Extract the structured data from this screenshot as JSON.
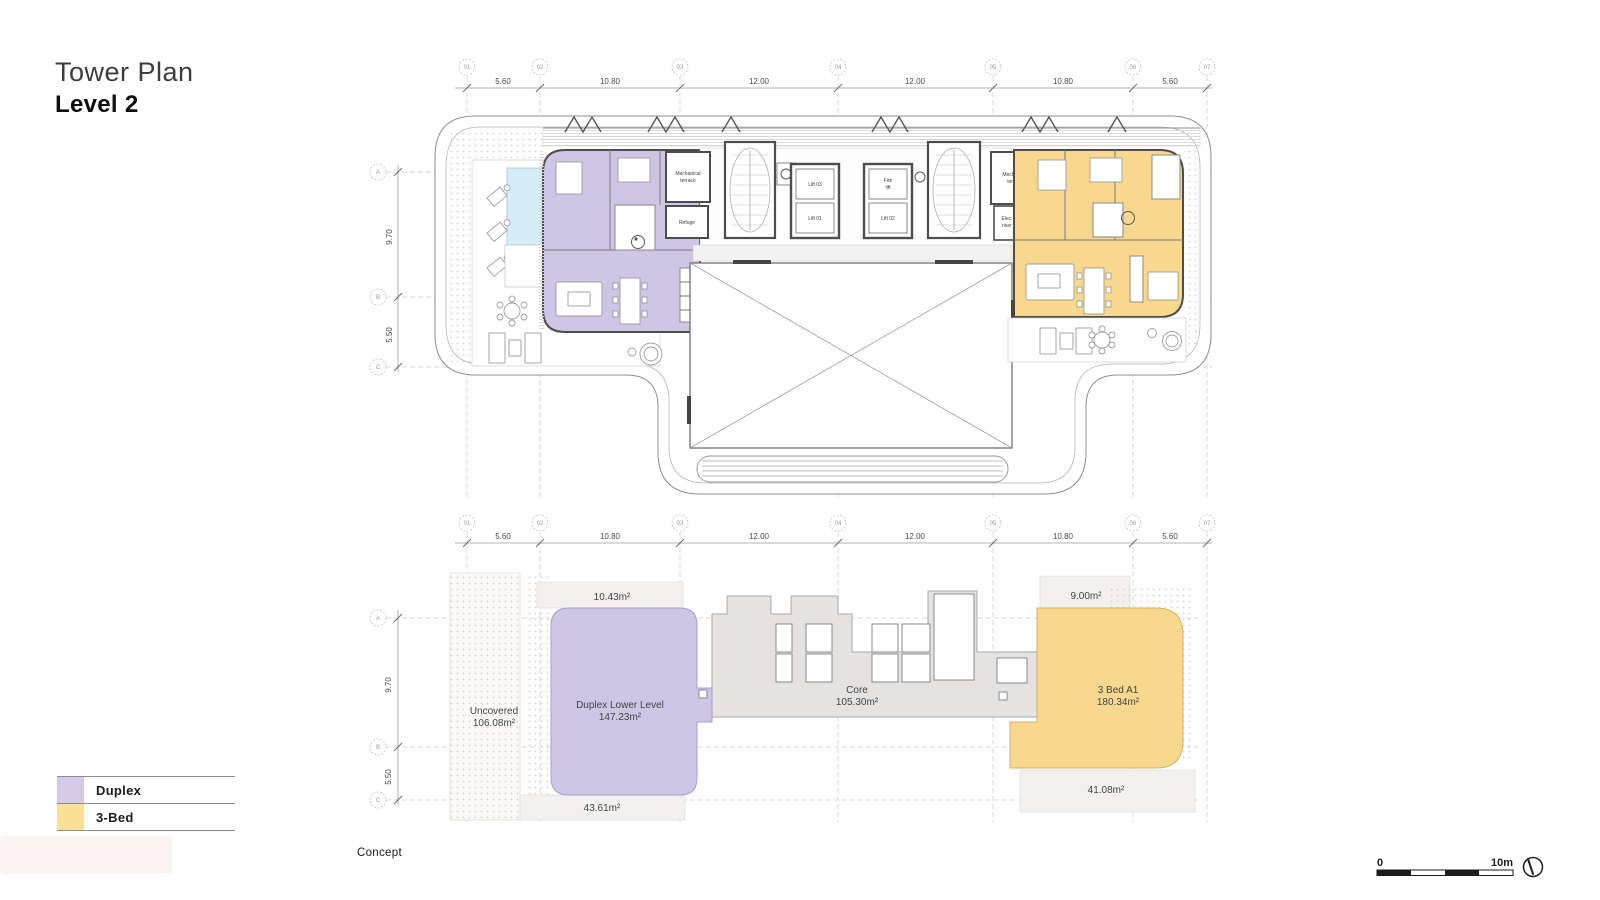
{
  "title": {
    "line1": "Tower Plan",
    "line2": "Level 2"
  },
  "grid": {
    "cols": [
      "01",
      "02",
      "03",
      "04",
      "05",
      "06",
      "07"
    ],
    "col_dims": [
      "5.60",
      "10.80",
      "12.00",
      "12.00",
      "10.80",
      "5.60"
    ],
    "rows": [
      "A",
      "B",
      "C"
    ],
    "row_dims": [
      "9.70",
      "5.50"
    ]
  },
  "top_plan": {
    "mech_terrace_line1": "Mechanical",
    "mech_terrace_line2": "terrace",
    "refuge": "Refuge",
    "elec_line1": "Elec.",
    "elec_line2": "riser",
    "lift03": "Lift 03",
    "lift01": "Lift 01",
    "lift02": "Lift 02",
    "fire_line1": "Fire",
    "fire_line2": "lift"
  },
  "lower_plan": {
    "uncovered_name": "Uncovered",
    "uncovered_area": "106.08m²",
    "duplex_name": "Duplex Lower Level",
    "duplex_area": "147.23m²",
    "core_name": "Core",
    "core_area": "105.30m²",
    "bed_name": "3 Bed A1",
    "bed_area": "180.34m²",
    "terrace_tl": "10.43m²",
    "terrace_bl": "43.61m²",
    "terrace_tr": "9.00m²",
    "terrace_br": "41.08m²"
  },
  "legend": {
    "items": [
      {
        "label": "Duplex",
        "color": "#d5cbe8"
      },
      {
        "label": "3-Bed",
        "color": "#fadf95"
      }
    ]
  },
  "footer": {
    "stage": "Concept"
  },
  "scale_bar": {
    "start": "0",
    "end": "10m"
  },
  "colors": {
    "duplex": "#cfc5e4",
    "three_bed": "#f8d88e",
    "core": "#e4e3e2",
    "pool": "#d6ecf7"
  }
}
